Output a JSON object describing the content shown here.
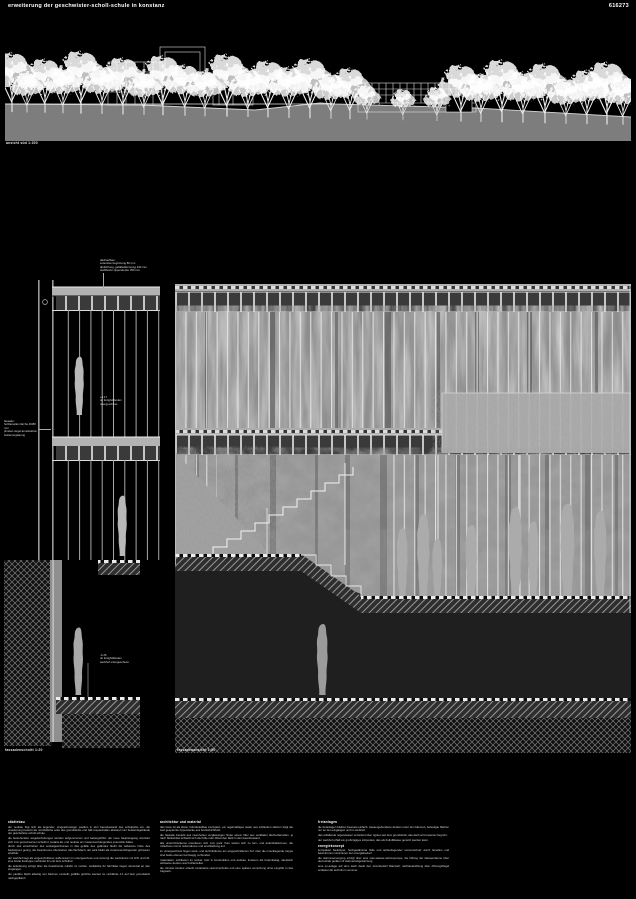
{
  "header": {
    "title": "erweiterung der geschwister-scholl-schule in konstanz",
    "code": "616273"
  },
  "drawings": {
    "site_elevation": {
      "label": "ansicht süd 1:200"
    },
    "facade_section": {
      "label": "fassadenschnitt 1:20",
      "annotations": {
        "roof": [
          "dachaufbau:",
          "extensive begrünung 80 mm",
          "abdichtung, gefälledämmung 240 mm",
          "stahlbeton-rippendecke 350 mm"
        ],
        "wall": [
          "fassade:",
          "holzlamellen lärche 40/80 mm",
          "pfosten-riegel-konstruktion",
          "isolierverglasung"
        ],
        "level_upper": [
          "+4.17",
          "ok fertigfußboden",
          "obergeschoss"
        ],
        "level_lower": [
          "-3.45",
          "ok fertigfußboden",
          "werkhof untergeschoss"
        ]
      }
    },
    "elevation": {
      "label": "fassadenansicht 1:50"
    }
  },
  "text_columns": [
    {
      "heading": "städtebau",
      "paragraphs": [
        "der neubau fügt sich als liegender, eingeschossiger pavillon in den baumbestand des schulparks ein. die erweiterung besetzt die nordöstliche ecke des grundstücks und hält respektvollen abstand zum bestandsgebäude der geschwister-scholl-schule.",
        "die bestehenden wegebeziehungen werden aufgenommen und weitergeführt. der neue haupteingang orientiert sich zum gemeinsamen schulhof, sodass alt- und neubau ein zusammenhängendes ensemble bilden.",
        "durch das einschieben des sockelgeschosses in das gefälle des geländes bleibt die wirksame höhe des baukörpers gering. die baumkronen überstehen das flachdach, der park bleibt als zusammenhängender grünraum erlebbar.",
        "der werkhof liegt als eingeschnittener außenraum im untergeschoss und versorgt die werkräume mit licht und luft. eine breite freitreppe verbindet ihn mit dem schulhof.",
        "die anlieferung erfolgt über die bestehende zufahrt im norden. stellplätze für fahrräder liegen dezentral an den eingängen.",
        "der pavillon bleibt allseitig von bäumen umstellt; gefällte gehölze werden im verhältnis 1:1 auf dem grundstück nachgepflanzt."
      ]
    },
    {
      "heading": "architektur und material",
      "paragraphs": [
        "das haus ist als klarer holzskelettbau konzipiert. ein regelmäßiges raster aus schlanken stützen trägt die weit gespannte rippendecke aus brettschichtholz.",
        "die fassade besteht aus raumhohen verglasungen hinter einem filter aus vertikalen lärchenlamellen. je nach blickwinkel schließt sich die hülle oder öffnet den blick in den baumbestand.",
        "alle unterrichtsräume orientieren sich zum park. flure weiten sich zu lern- und aufenthaltszonen, die mittelzone nimmt nebenräume und erschließung auf.",
        "im untergeschoss liegen werk- und technikräume am eingeschnittenen hof. über die innenliegende treppe sind beide ebenen kurzwegig verbunden.",
        "materialien: sichtbeton im sockel, holz in konstruktion und ausbau, linoleum als bodenbelag, akustisch wirksame decken aus holzlamellen.",
        "die robuste struktur erlaubt veränderte raumzuschnitte und eine spätere umnutzung ohne eingriffe in das tragwerk."
      ]
    },
    {
      "heading": "freianlagen",
      "paragraphs": [
        "die freianlagen bleiben bewusst einfach: wassergebundene decken unter den bäumen, befestigte flächen nur an den eingängen und im werkhof.",
        "das anfallende regenwasser versickert über rigolen auf dem grundstück; das dach wird extensiv begrünt.",
        "der werkhof erhält ein großzügiges sitzpodest, das als freiluftklasse genutzt werden kann."
      ],
      "subheading": "energiekonzept",
      "paragraphs2": [
        "kompakter baukörper, hochgedämmte hülle und außenliegender sonnenschutz durch lamellen und baumkronen minimieren den energiebedarf.",
        "die wärmeversorgung erfolgt über eine sole-wasser-wärmepumpe, die lüftung der klassenräume über dezentrale geräte mit wärmerückgewinnung.",
        "eine pv-anlage auf dem dach deckt den strombedarf bilanziell; nachtauskühlung über öffnungsflügel entlastet die technik im sommer."
      ]
    }
  ]
}
